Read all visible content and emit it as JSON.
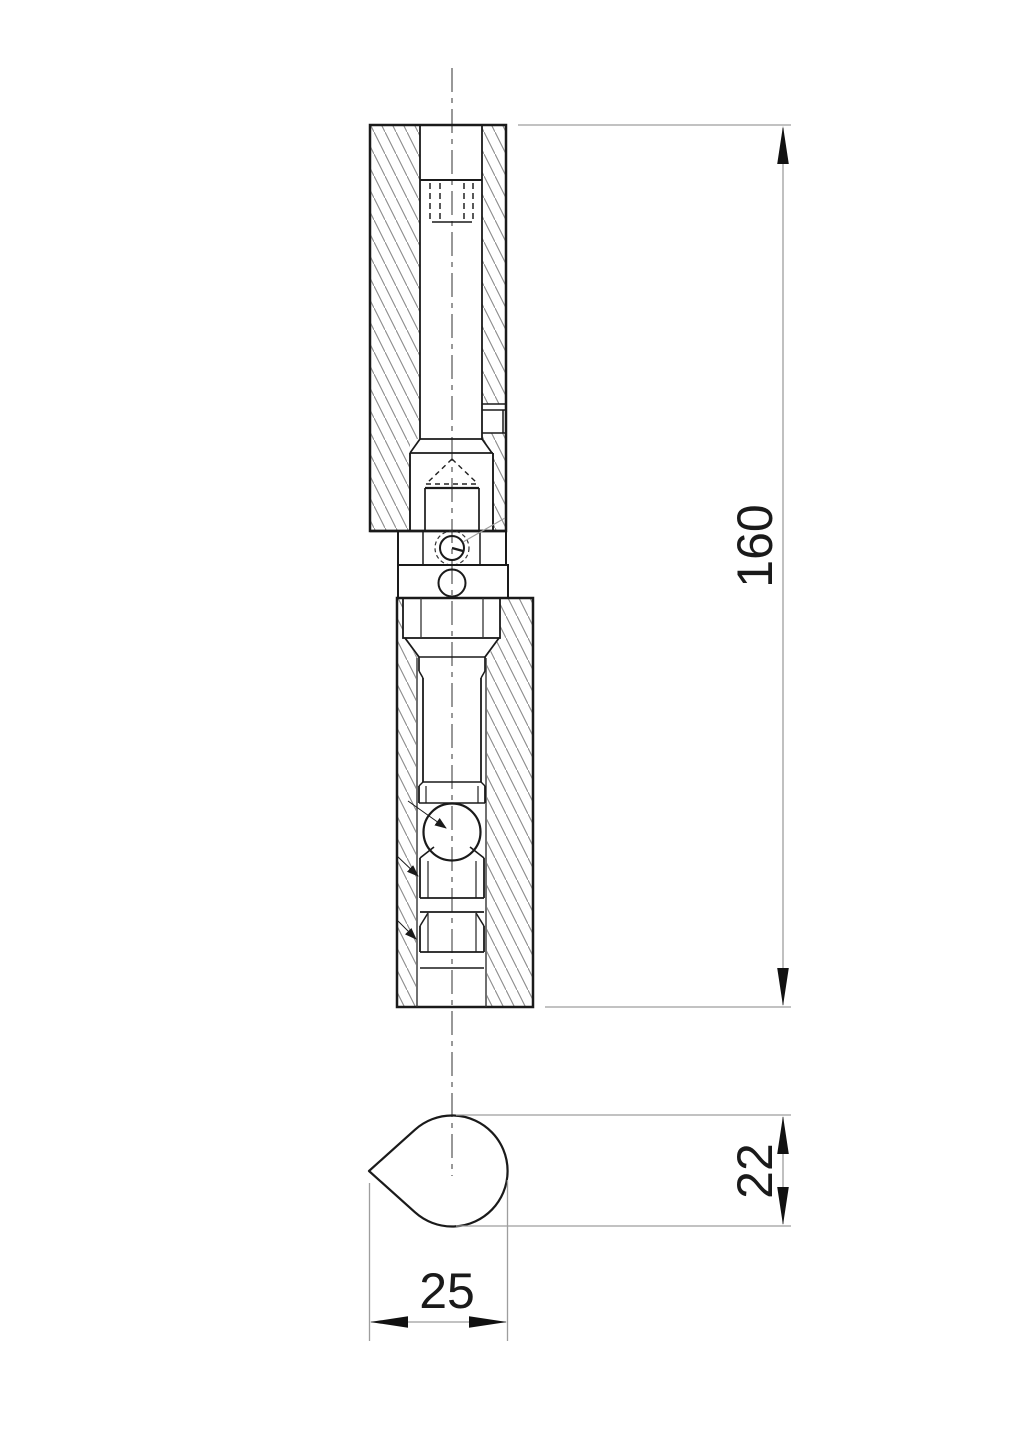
{
  "drawing": {
    "dimensions": {
      "overall_length": "160",
      "tip_height": "22",
      "tip_width": "25"
    },
    "colors": {
      "outline": "#1a1a1a",
      "inner_line": "#333333",
      "hatch": "#8c8c8c",
      "dimension_line": "#9e9e9e",
      "centerline": "#606060",
      "background": "#ffffff"
    }
  }
}
